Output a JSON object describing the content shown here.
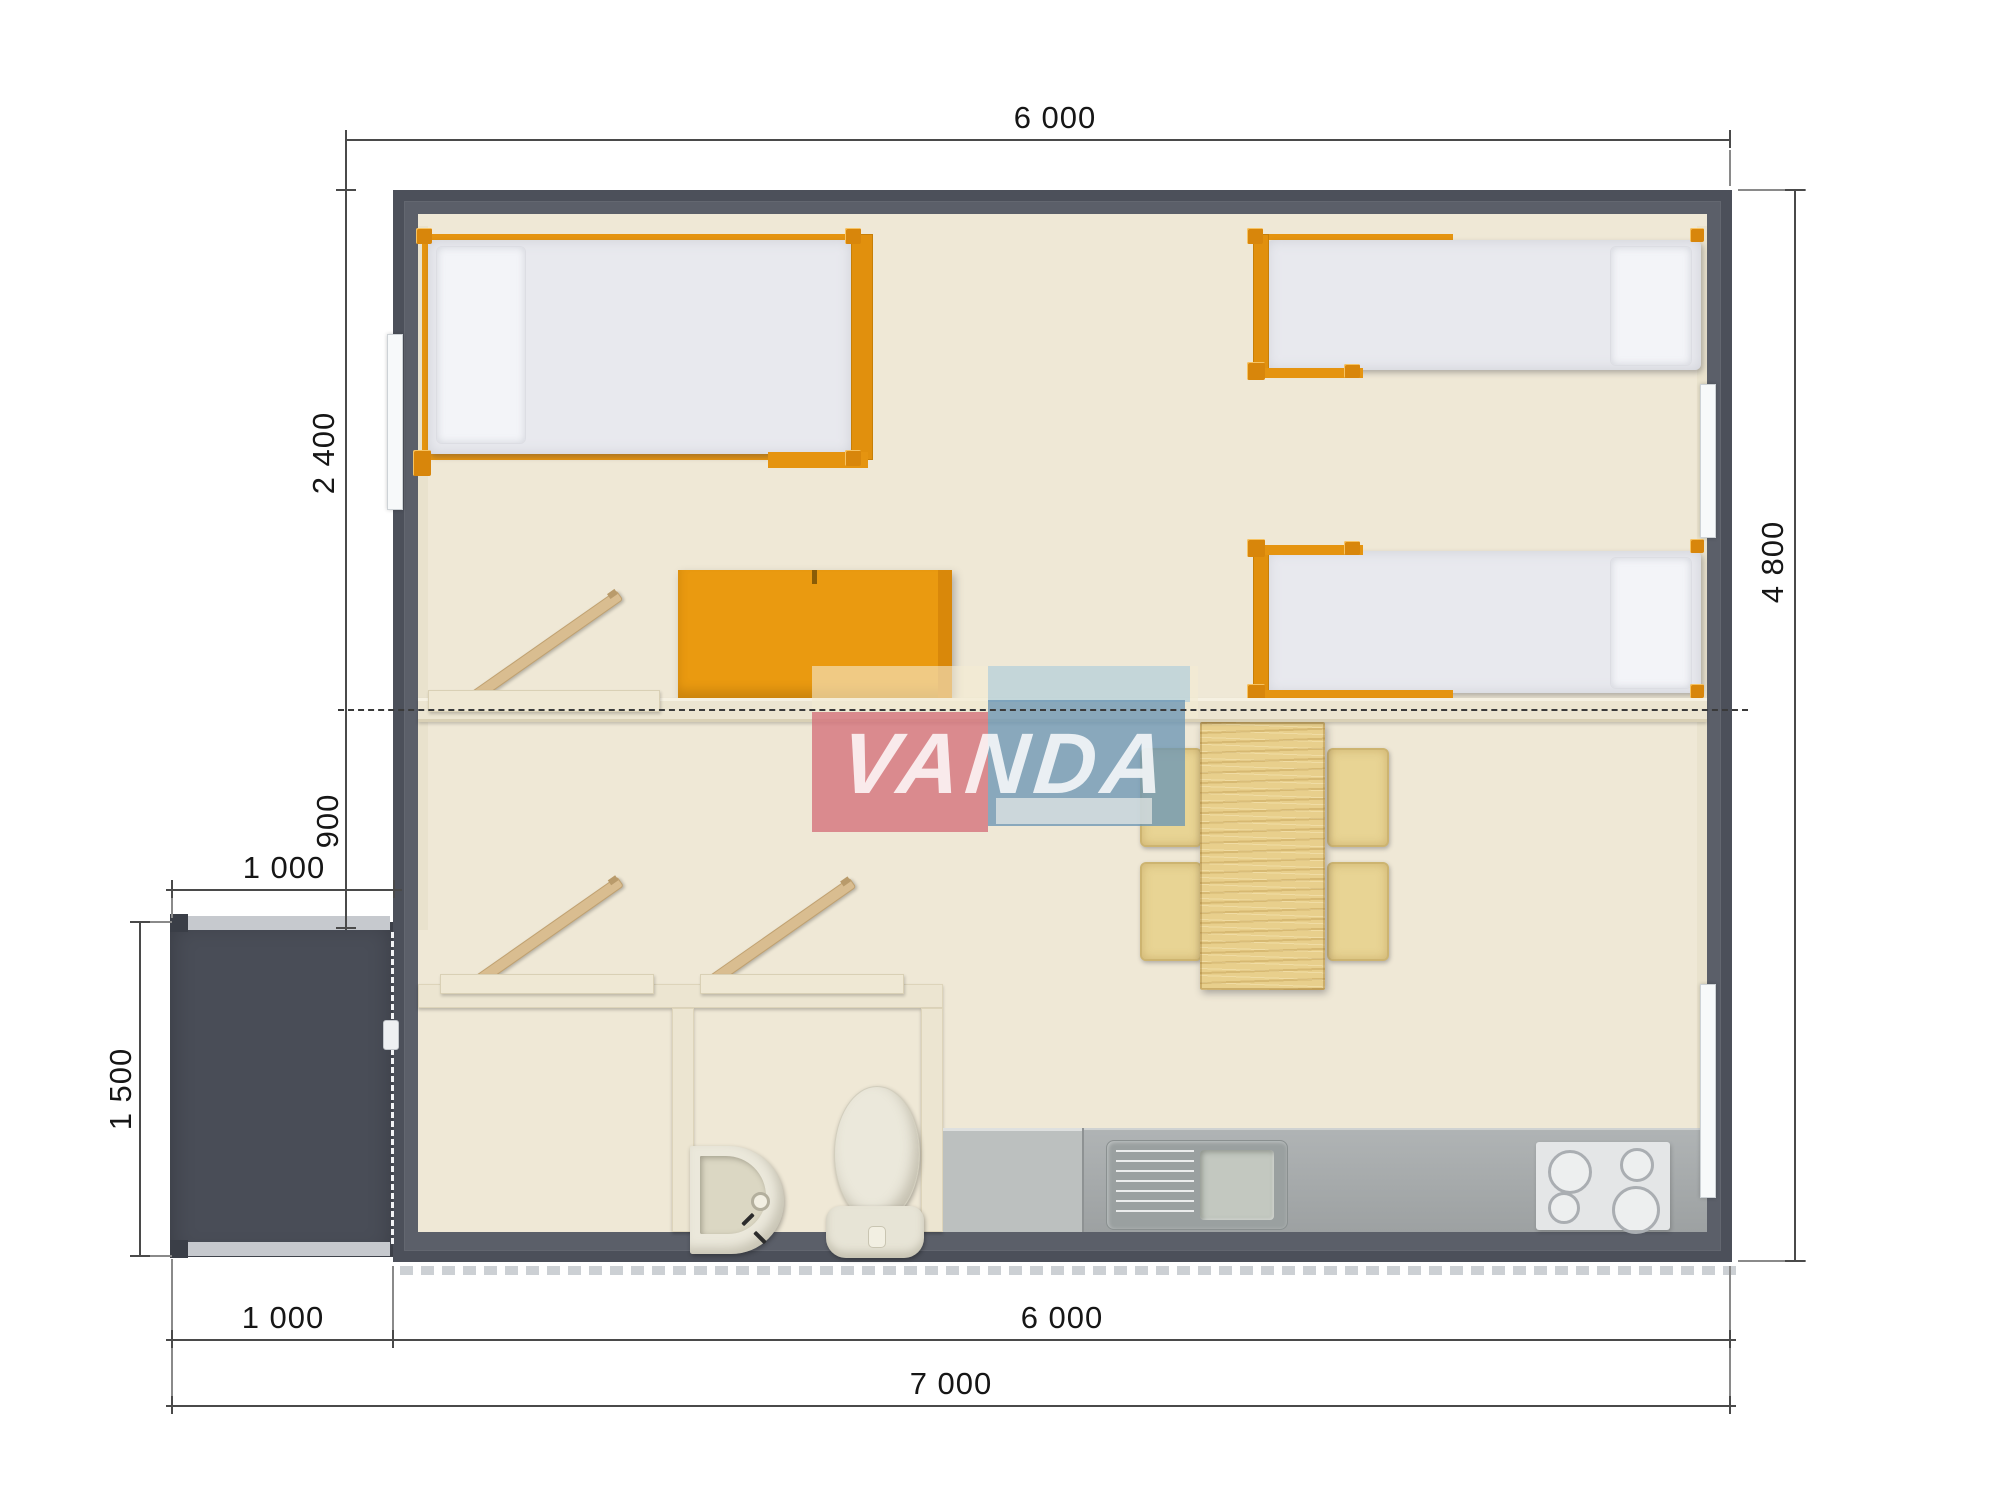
{
  "watermark": {
    "text": "VANDA"
  },
  "dimensions": {
    "top_width": "6 000",
    "right_height": "4 800",
    "left_upper": "2 400",
    "left_middle": "900",
    "porch_top_width": "1 000",
    "porch_left_height": "1 500",
    "bottom_porch": "1 000",
    "bottom_main": "6 000",
    "bottom_total": "7 000"
  },
  "palette": {
    "wall_gray": "#5b5f69",
    "porch_gray": "#494d57",
    "carpet_gray": "#a9a6ab",
    "accent_orange": "#e8960e",
    "wood_pine": "#e8cf8c",
    "cream_wall": "#ece5d1",
    "counter_gray": "#a2a6a7",
    "fixture_white": "#ebe8db",
    "dimension_line": "#4a4a4a",
    "watermark_pink": "#d4707a",
    "watermark_blue": "#6c96b5",
    "watermark_cream": "#f3ebd2"
  }
}
